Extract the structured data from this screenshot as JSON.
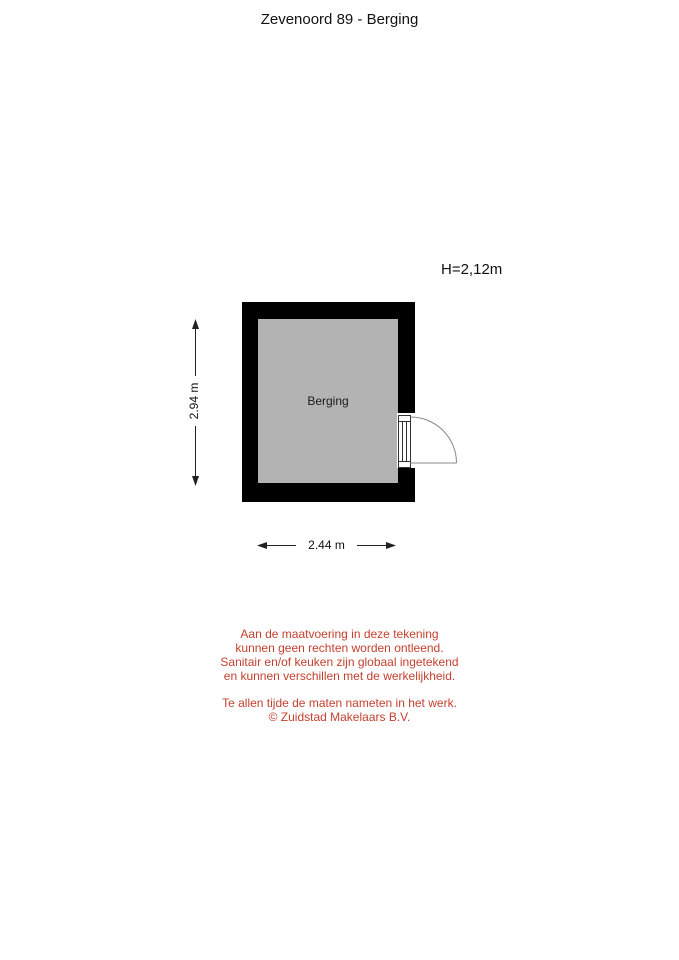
{
  "title": "Zevenoord 89 - Berging",
  "plan": {
    "ceiling_height_label": "H=2,12m",
    "room_label": "Berging",
    "width_dimension": "2.44 m",
    "height_dimension": "2.94 m",
    "colors": {
      "wall": "#000000",
      "floor": "#b3b3b3",
      "line": "#222222",
      "door-line": "#888888",
      "disclaimer": "#c5402f"
    }
  },
  "disclaimer": {
    "paragraph1": [
      "Aan de maatvoering in deze tekening",
      "kunnen geen rechten worden ontleend.",
      "Sanitair en/of keuken zijn globaal ingetekend",
      "en kunnen verschillen met de werkelijkheid."
    ],
    "paragraph2": [
      "Te allen tijde de maten nameten in het werk.",
      "© Zuidstad Makelaars B.V."
    ]
  }
}
